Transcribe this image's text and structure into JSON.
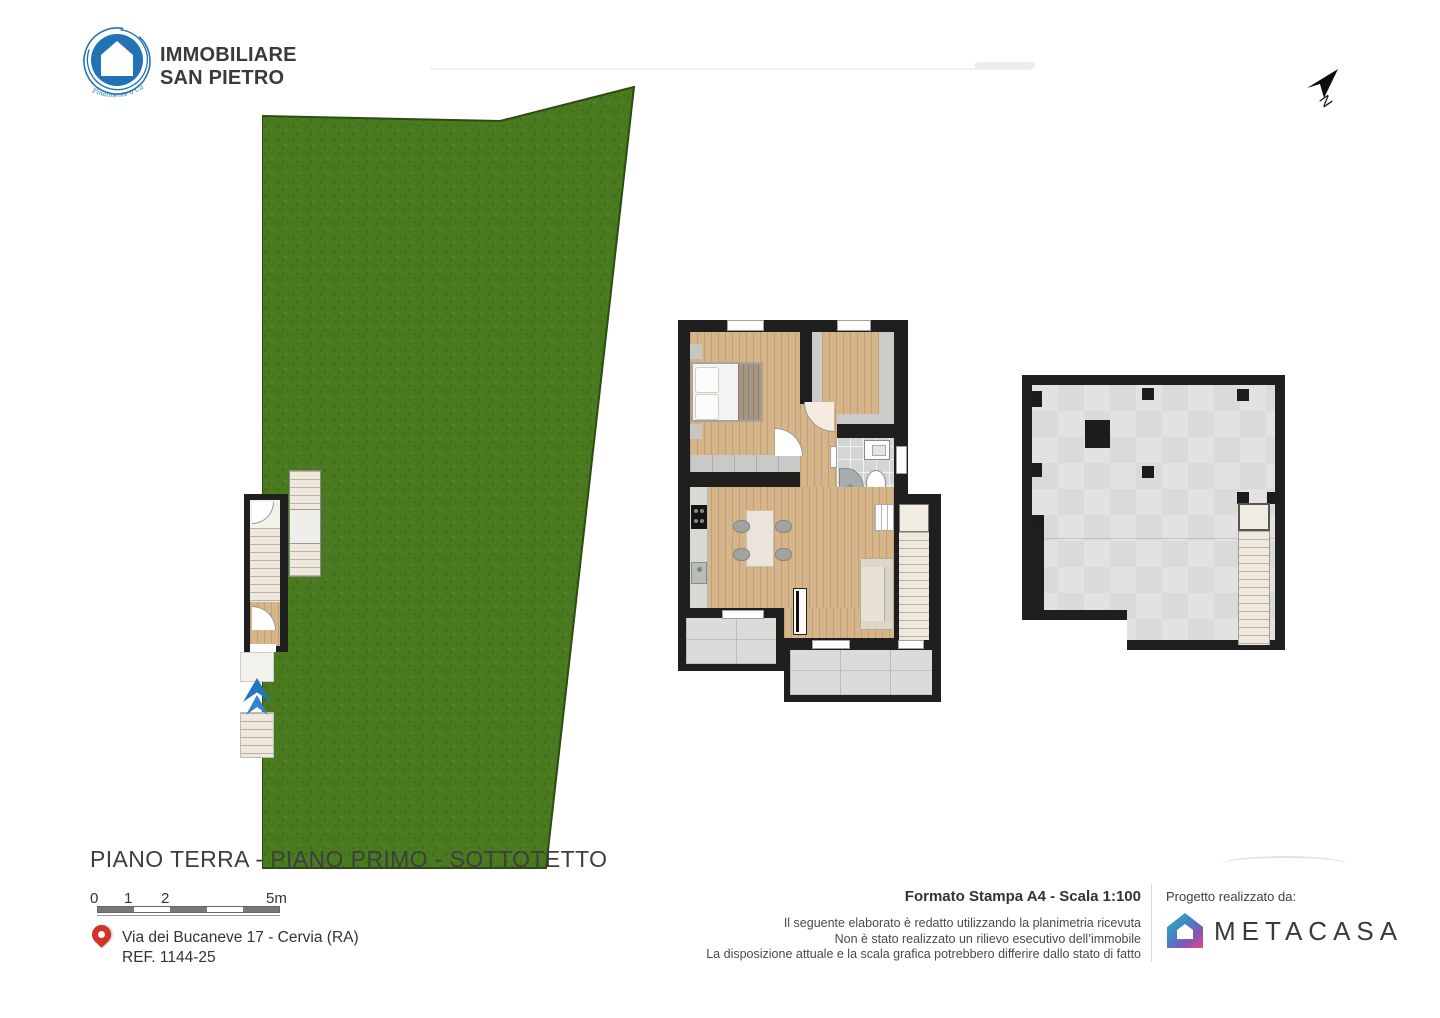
{
  "logo": {
    "line1": "IMMOBILIARE",
    "line2": "SAN PIETRO",
    "tagline": "Finalmente a Casa"
  },
  "north": {
    "label": "N"
  },
  "sheet": {
    "title": "PIANO TERRA - PIANO PRIMO - SOTTOTETTO"
  },
  "scale_bar": {
    "labels": [
      "0",
      "1",
      "2",
      "5m"
    ]
  },
  "address": {
    "line1": "Via dei Bucaneve 17 - Cervia (RA)",
    "ref": "REF. 1144-25"
  },
  "print": {
    "format": "Formato Stampa A4 - Scala 1:100",
    "disclaimer": [
      "Il seguente elaborato è redatto utilizzando la planimetria ricevuta",
      "Non è stato realizzato un rilievo esecutivo dell’immobile",
      "La disposizione attuale e la scala grafica potrebbero differire dallo stato di fatto"
    ]
  },
  "credit": {
    "label": "Progetto realizzato da:",
    "brand": "METACASA"
  },
  "colors": {
    "grass": "#4a7a1f",
    "wall": "#1f1f1f",
    "wood": "#d6b58a",
    "bath_tile": "#d4d6d6",
    "attic_floor": "#dedddb",
    "terrace": "#dbdbd9",
    "logo_blue": "#2273b6",
    "entry_arrow_blue": "#2077bd",
    "pin_red": "#d63127"
  }
}
